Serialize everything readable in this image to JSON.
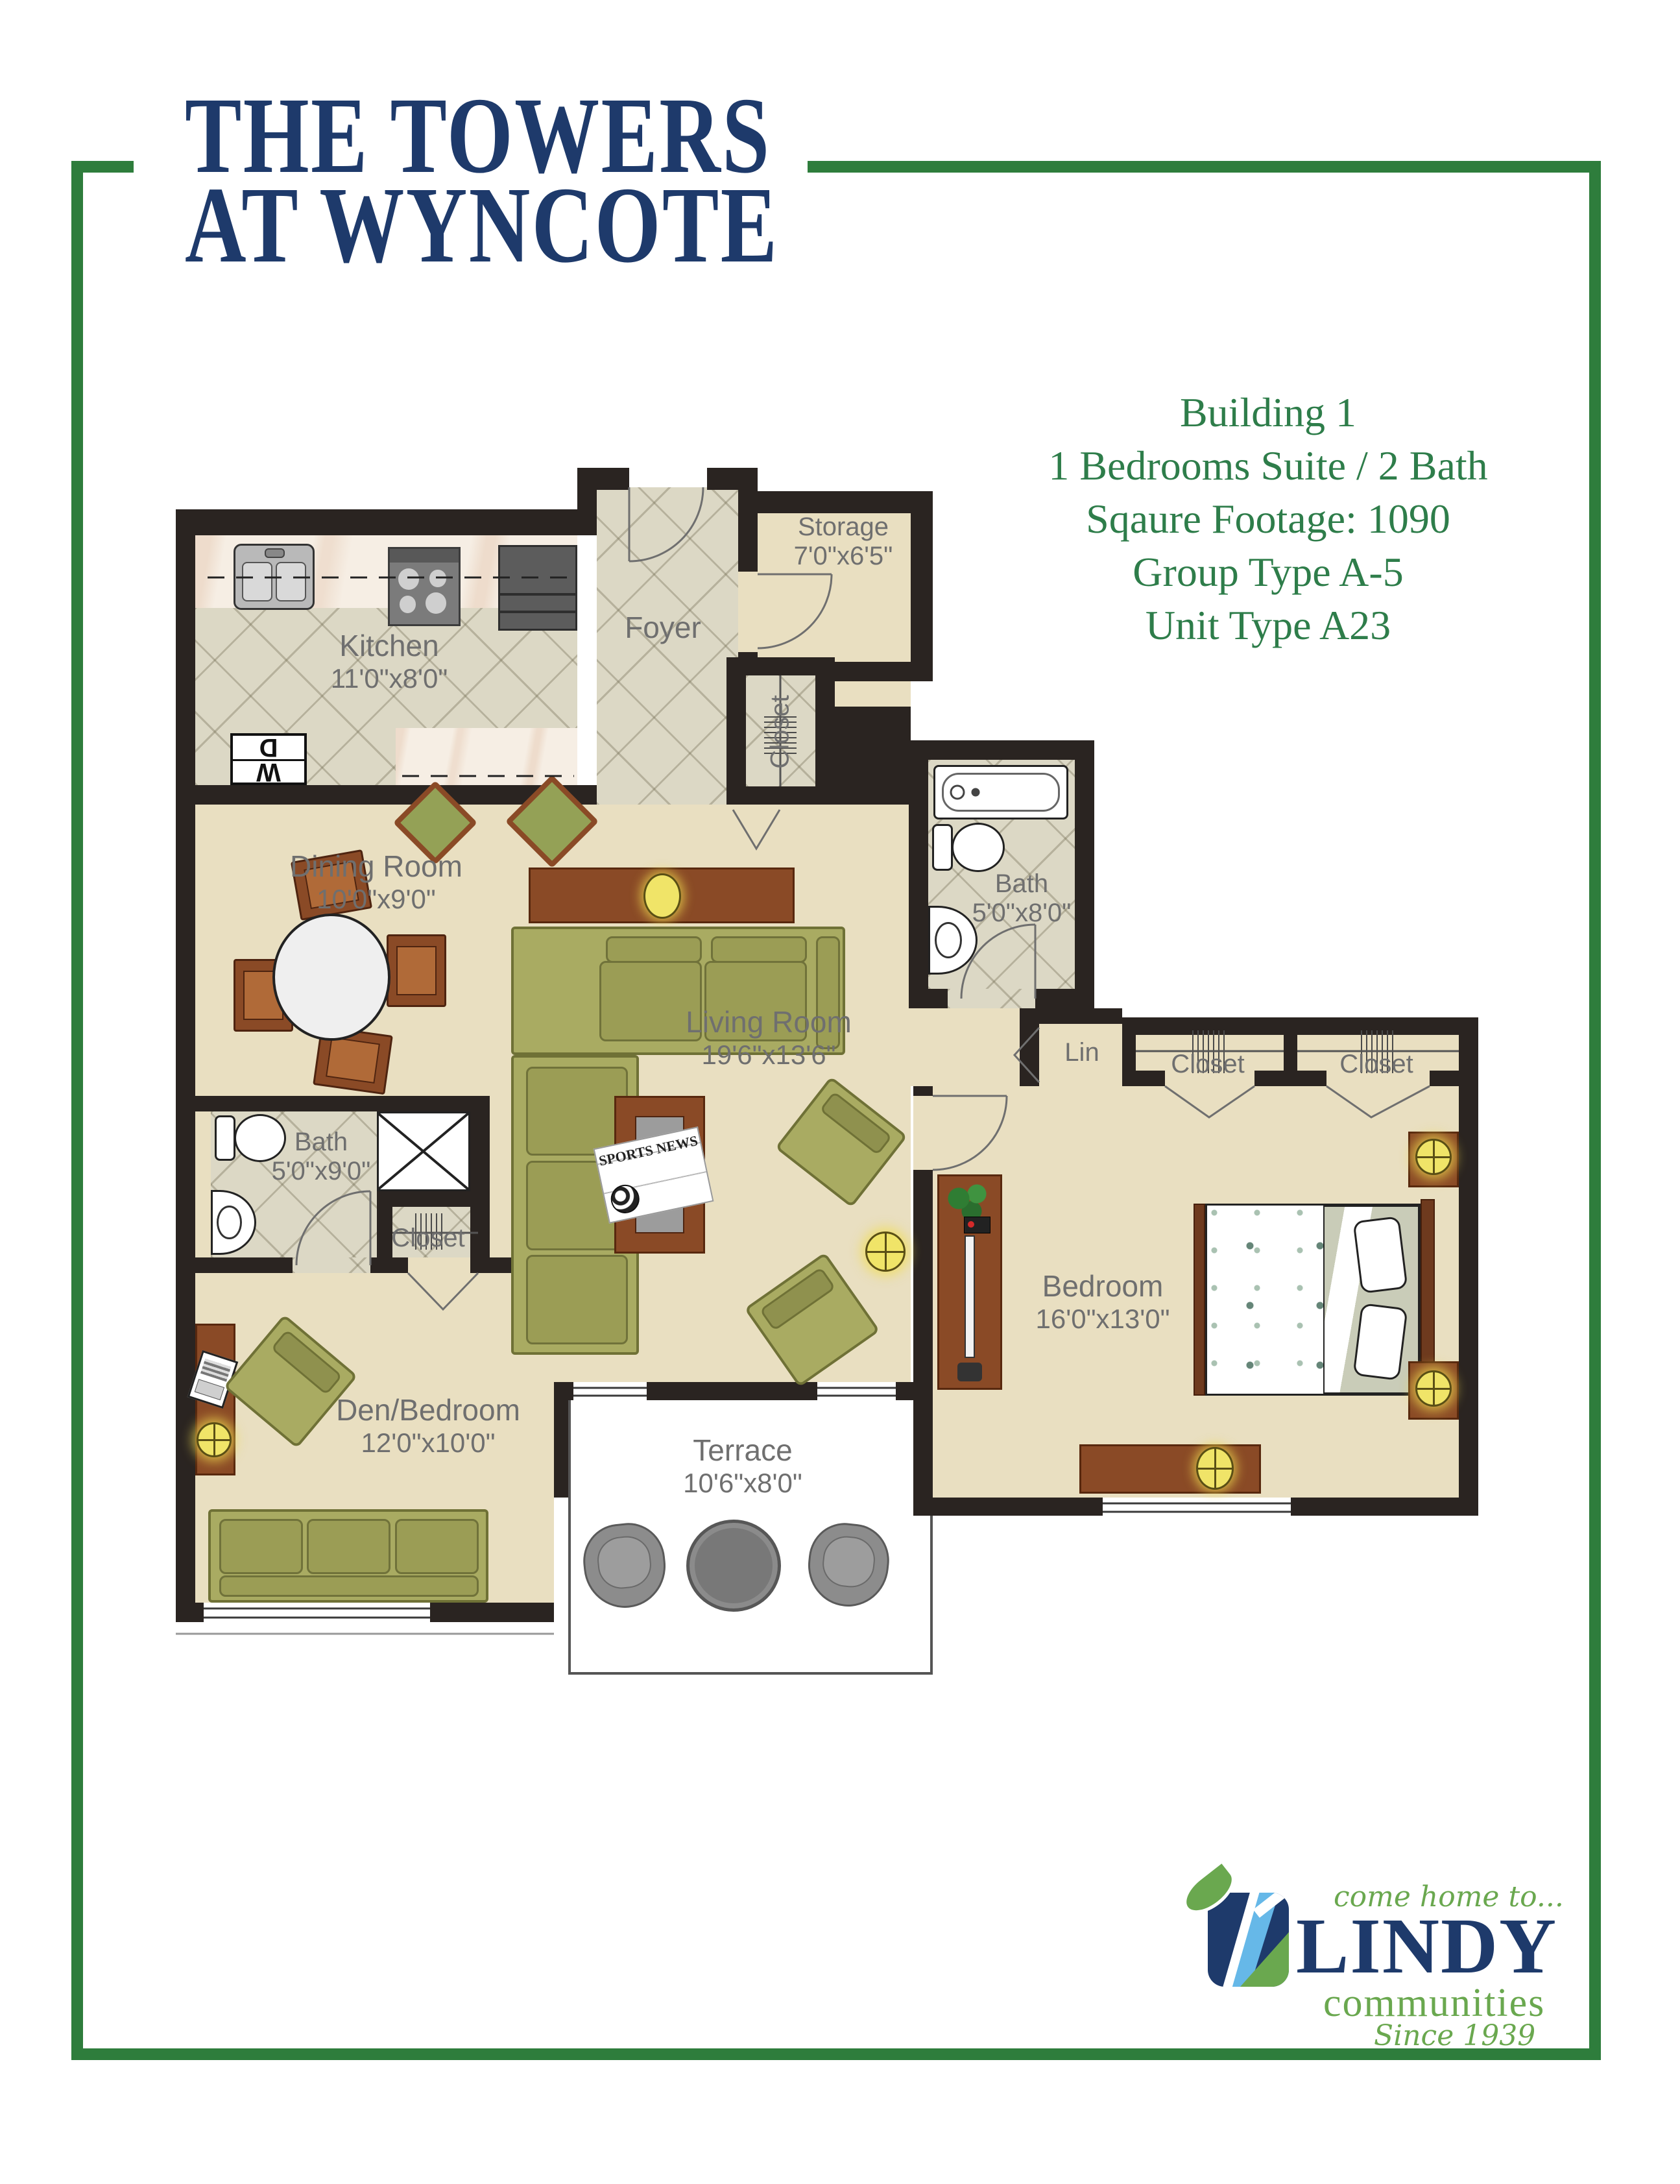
{
  "page": {
    "title_line1": "THE TOWERS",
    "title_line2": "AT WYNCOTE"
  },
  "info": {
    "lines": [
      "Building 1",
      "1 Bedrooms Suite / 2 Bath",
      "Sqaure Footage: 1090",
      "Group Type A-5",
      "Unit Type A23"
    ]
  },
  "rooms": [
    {
      "name": "Kitchen",
      "dims": "11'0\"x8'0\""
    },
    {
      "name": "Foyer",
      "dims": ""
    },
    {
      "name": "Storage",
      "dims": "7'0\"x6'5\""
    },
    {
      "name": "Closet",
      "dims": ""
    },
    {
      "name": "Dining Room",
      "dims": "10'0\"x9'0\""
    },
    {
      "name": "Living Room",
      "dims": "19'6\"x13'6\""
    },
    {
      "name": "Bath",
      "dims": "5'0\"x8'0\""
    },
    {
      "name": "Lin",
      "dims": ""
    },
    {
      "name": "Closet",
      "dims": ""
    },
    {
      "name": "Closet",
      "dims": ""
    },
    {
      "name": "Bedroom",
      "dims": "16'0\"x13'0\""
    },
    {
      "name": "Bath",
      "dims": "5'0\"x9'0\""
    },
    {
      "name": "Closet",
      "dims": ""
    },
    {
      "name": "Den/Bedroom",
      "dims": "12'0\"x10'0\""
    },
    {
      "name": "Terrace",
      "dims": "10'6\"x8'0\""
    }
  ],
  "appliances": {
    "washer": "W",
    "dryer": "D"
  },
  "newspaper": {
    "title": "SPORTS NEWS"
  },
  "logo": {
    "tagline": "come home to...",
    "name": "LINDY",
    "sub": "communities",
    "since": "Since 1939"
  },
  "colors": {
    "frame_green": "#2e7d3c",
    "title_navy": "#1e3a6b",
    "info_green": "#2e7d4a",
    "wall_dark": "#2a2421",
    "label_gray": "#6f6f6f",
    "floor_beige": "#e9dfc1",
    "sofa_green": "#a9ab62",
    "wood_brown": "#8a4a26",
    "lamp_yellow": "#f0e468",
    "logo_blue": "#66b8e8",
    "logo_green": "#6aa84f"
  }
}
